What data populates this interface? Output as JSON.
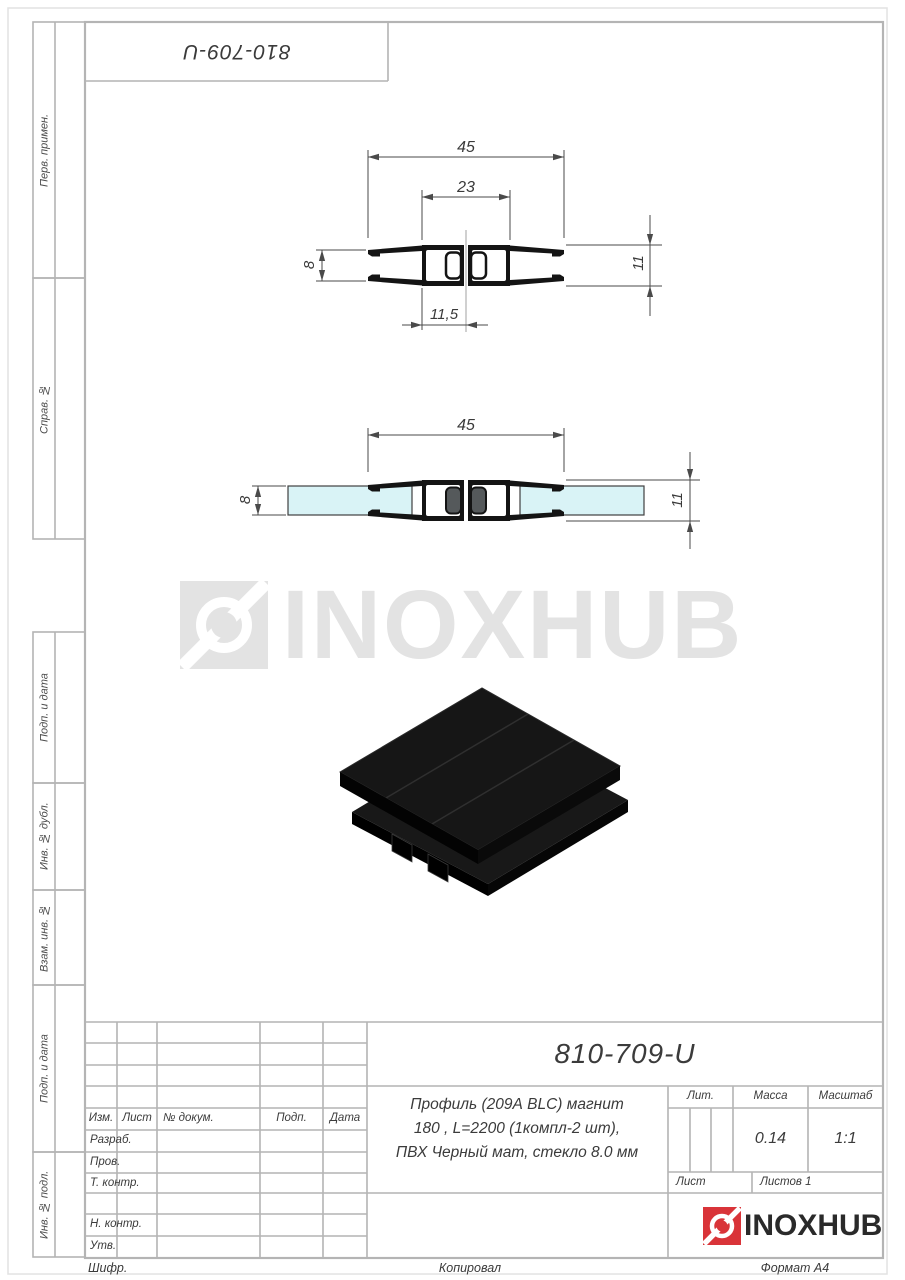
{
  "margin_labels": [
    "Перв. примен.",
    "Справ. №",
    "Подп. и дата",
    "Инв. № дубл.",
    "Взам. инв. №",
    "Подп. и дата",
    "Инв. № подл."
  ],
  "watermark": {
    "brand": "INOXHUB"
  },
  "drawing1": {
    "dims": {
      "overall_width": "45",
      "inner_width": "23",
      "glass_gap": "8",
      "height": "11",
      "half_width": "11,5"
    }
  },
  "drawing2": {
    "dims": {
      "overall_width": "45",
      "glass_thickness": "8",
      "height": "11"
    }
  },
  "title_block": {
    "designation": "810-709-U",
    "description_lines": [
      "Профиль (209А BLC) магнит",
      "180 , L=2200 (1компл-2 шт),",
      "ПВХ Черный мат, стекло 8.0 мм"
    ],
    "header_cols": [
      "Изм.",
      "Лист",
      "№ докум.",
      "Подп.",
      "Дата"
    ],
    "sign_rows": [
      "Разраб.",
      "Пров.",
      "Т. контр.",
      "Н. контр.",
      "Утв."
    ],
    "lit_label": "Лит.",
    "massa_label": "Масса",
    "masshtab_label": "Масштаб",
    "massa_value": "0.14",
    "masshtab_value": "1:1",
    "sheet_label": "Лист",
    "sheets_label": "Листов 1",
    "brand": "INOXHUB"
  },
  "footer": {
    "cipher": "Шифр.",
    "copied": "Копировал",
    "format": "Формат А4"
  },
  "colors": {
    "accent_red": "#d93439",
    "glass": "#d9f3f6",
    "frame_gray": "#b4b4b4",
    "ink": "#141414",
    "watermark_gray": "#e3e3e3"
  }
}
